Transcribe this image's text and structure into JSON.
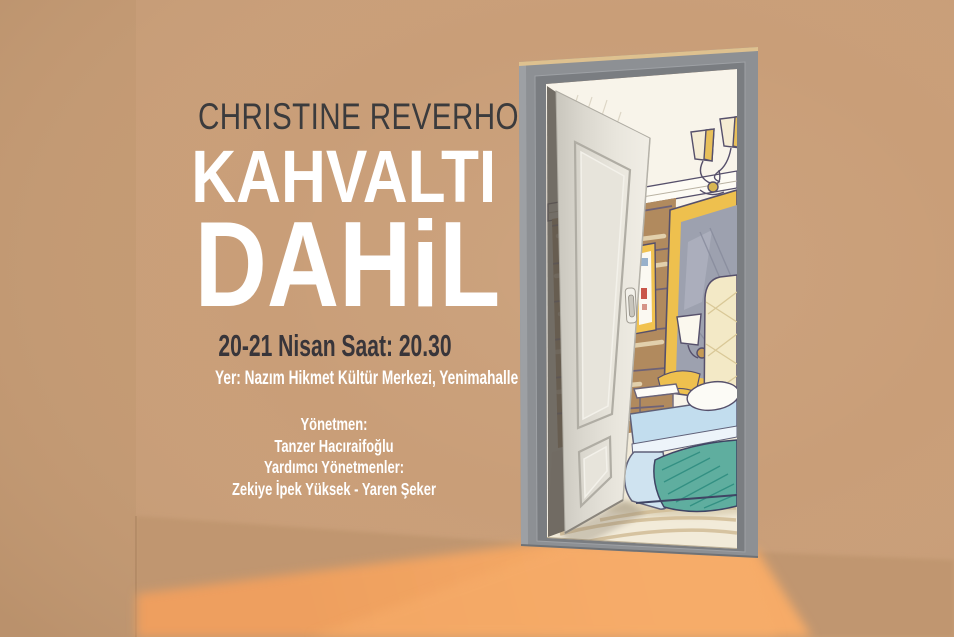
{
  "poster": {
    "author": "CHRISTINE REVERHO",
    "title_line1": "KAHVALTI",
    "title_line2": "DAHiL",
    "date_line": "20-21 Nisan Saat: 20.30",
    "venue_line": "Yer: Nazım Hikmet Kültür Merkezi, Yenimahalle",
    "credits": {
      "director_label": "Yönetmen:",
      "director_name": "Tanzer Hacıraifoğlu",
      "assistants_label": "Yardımcı Yönetmenler:",
      "assistants_names": "Zekiye İpek Yüksek - Yaren Şeker"
    },
    "colors": {
      "wall": "#c99e78",
      "floor": "#c0966f",
      "light_beam": "#f2a665",
      "door_frame": "#8d9094",
      "door_frame_inner": "#7a7d81",
      "door_face": "#e6e3da",
      "room_wall": "#f8f4ea",
      "wood_panel": "#b18a5e",
      "gold": "#eec04e",
      "mirror_glass": "#9da1af",
      "bed_blue": "#c2ddee",
      "blanket_teal": "#5fae9f",
      "headboard_cream": "#f3e9c6",
      "author_text": "#3b3b3d",
      "date_text": "#38353a",
      "title_text": "#ffffff"
    }
  }
}
